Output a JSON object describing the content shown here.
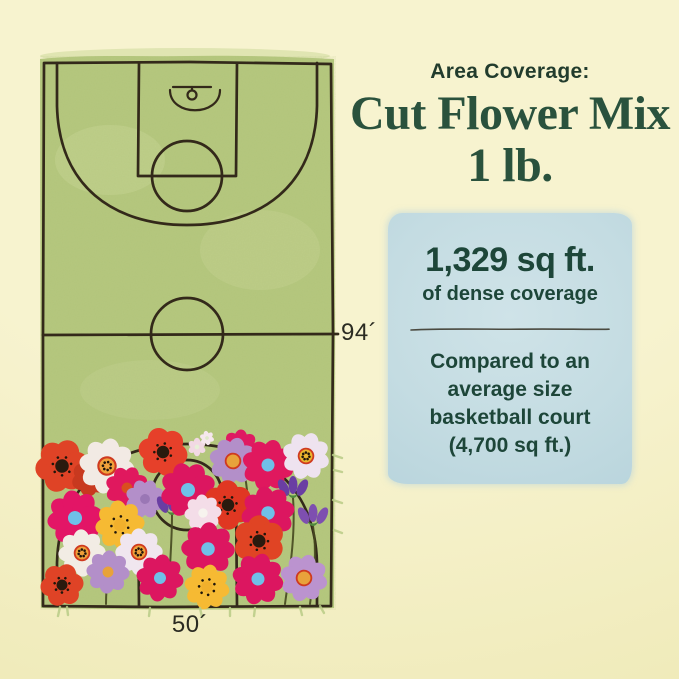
{
  "header": {
    "eyebrow": "Area Coverage:",
    "title_line1": "Cut Flower Mix",
    "title_line2": "1 lb."
  },
  "coverage_box": {
    "headline": "1,329 sq ft.",
    "subhead": "of dense coverage",
    "comparison_lines": [
      "Compared to an",
      "average size",
      "basketball court",
      "(4,700 sq ft.)"
    ]
  },
  "court": {
    "length_label": "94´",
    "width_label": "50´",
    "length_feet": 94,
    "width_feet": 50
  },
  "theme": {
    "bg": "#f7f3cf",
    "bg-edge": "#efeab8",
    "green": "#b5c87e",
    "green-light": "#cdd99b",
    "line": "#33291a",
    "ink-title": "#2a523d",
    "ink-eyebrow": "#223c2d",
    "label-ink": "#2b2b22",
    "box-bg": "#c4dce2",
    "box-ink": "#1d4639",
    "divider-ink": "#4a4a40",
    "stem": "#45471f",
    "grass": "#b9cb86"
  },
  "flowers": [
    {
      "x": 197,
      "y": 447,
      "r": 9,
      "n": 6,
      "type": "daisy",
      "petal": "#f2d9e4",
      "center": "#e8f0d8"
    },
    {
      "x": 207,
      "y": 438,
      "r": 7,
      "n": 6,
      "type": "daisy",
      "petal": "#f6e7ee",
      "center": "#dfe8c9"
    },
    {
      "x": 240,
      "y": 448,
      "r": 18,
      "type": "daisy",
      "petal": "#df1a62",
      "center": "#8a1f45"
    },
    {
      "x": 62,
      "y": 466,
      "r": 26,
      "type": "poppy",
      "petal": "#df4326",
      "center": "#2a1a0e",
      "dots": true
    },
    {
      "x": 90,
      "y": 478,
      "r": 18,
      "type": "poppy",
      "petal": "#c8391f",
      "center": "#2a1a0e"
    },
    {
      "x": 107,
      "y": 466,
      "r": 27,
      "type": "daisy",
      "petal": "#f2eae4",
      "center": "#f0a23b",
      "ring": "#cf3a1f",
      "dots": true
    },
    {
      "x": 163,
      "y": 452,
      "r": 24,
      "type": "poppy",
      "petal": "#e6402a",
      "center": "#2a1a0e",
      "dots": true
    },
    {
      "x": 233,
      "y": 461,
      "r": 23,
      "type": "daisy",
      "petal": "#b38fc9",
      "center": "#e8a23b",
      "ring": "#cf3a1f"
    },
    {
      "x": 268,
      "y": 465,
      "r": 25,
      "type": "daisy",
      "petal": "#e0185e",
      "center": "#6fc0e8"
    },
    {
      "x": 306,
      "y": 456,
      "r": 23,
      "type": "daisy",
      "petal": "#eee3ef",
      "center": "#eab52e",
      "ring": "#cf3a1f",
      "dots": true
    },
    {
      "x": 127,
      "y": 488,
      "r": 21,
      "type": "daisy",
      "petal": "#e0185e",
      "center": "#d94f1f"
    },
    {
      "x": 145,
      "y": 499,
      "r": 19,
      "type": "daisy",
      "petal": "#b38fc9",
      "center": "#9a77b5"
    },
    {
      "x": 172,
      "y": 509,
      "type": "bud",
      "petal": "#6a3ea3"
    },
    {
      "x": 188,
      "y": 490,
      "r": 27,
      "type": "daisy",
      "petal": "#dc1660",
      "center": "#6fc0e8"
    },
    {
      "x": 228,
      "y": 505,
      "r": 24,
      "type": "poppy",
      "petal": "#e03722",
      "center": "#2a1a0e",
      "dots": true
    },
    {
      "x": 293,
      "y": 492,
      "type": "bud",
      "petal": "#6a3ea3"
    },
    {
      "x": 313,
      "y": 520,
      "type": "bud",
      "petal": "#7e4fb0"
    },
    {
      "x": 268,
      "y": 513,
      "r": 26,
      "type": "daisy",
      "petal": "#dc1660",
      "center": "#6fc0e8"
    },
    {
      "x": 75,
      "y": 518,
      "r": 27,
      "type": "daisy",
      "petal": "#e31566",
      "center": "#6fc0e8"
    },
    {
      "x": 120,
      "y": 525,
      "r": 24,
      "type": "daisy",
      "petal": "#f6ba33",
      "center": "#f1b02c",
      "dots": true
    },
    {
      "x": 203,
      "y": 513,
      "r": 18,
      "type": "daisy",
      "petal": "#f4dde8",
      "center": "#f7f3ee"
    },
    {
      "x": 82,
      "y": 553,
      "r": 23,
      "type": "daisy",
      "petal": "#f2ece4",
      "center": "#ef9f39",
      "ring": "#cf3a1f",
      "dots": true
    },
    {
      "x": 139,
      "y": 552,
      "r": 23,
      "type": "daisy",
      "petal": "#f0e6ef",
      "center": "#ef9f39",
      "ring": "#cf3a1f",
      "dots": true
    },
    {
      "x": 259,
      "y": 541,
      "r": 25,
      "type": "poppy",
      "petal": "#e04424",
      "center": "#2a1a0e",
      "dots": true
    },
    {
      "x": 208,
      "y": 549,
      "r": 26,
      "type": "daisy",
      "petal": "#dc1660",
      "center": "#6fc0e8"
    },
    {
      "x": 108,
      "y": 572,
      "r": 21,
      "type": "daisy",
      "petal": "#b38fc9",
      "center": "#e8a23b"
    },
    {
      "x": 62,
      "y": 585,
      "r": 21,
      "type": "poppy",
      "petal": "#df4326",
      "center": "#2a1a0e",
      "dots": true
    },
    {
      "x": 160,
      "y": 578,
      "r": 23,
      "type": "daisy",
      "petal": "#dc1660",
      "center": "#6fc0e8"
    },
    {
      "x": 207,
      "y": 587,
      "r": 22,
      "type": "daisy",
      "petal": "#f6ba33",
      "center": "#f1b02c",
      "dots": true
    },
    {
      "x": 258,
      "y": 579,
      "r": 25,
      "type": "daisy",
      "petal": "#dc1660",
      "center": "#6fc0e8"
    },
    {
      "x": 304,
      "y": 578,
      "r": 23,
      "type": "daisy",
      "petal": "#bb93cf",
      "center": "#e8a23b",
      "ring": "#cf3a1f"
    }
  ]
}
